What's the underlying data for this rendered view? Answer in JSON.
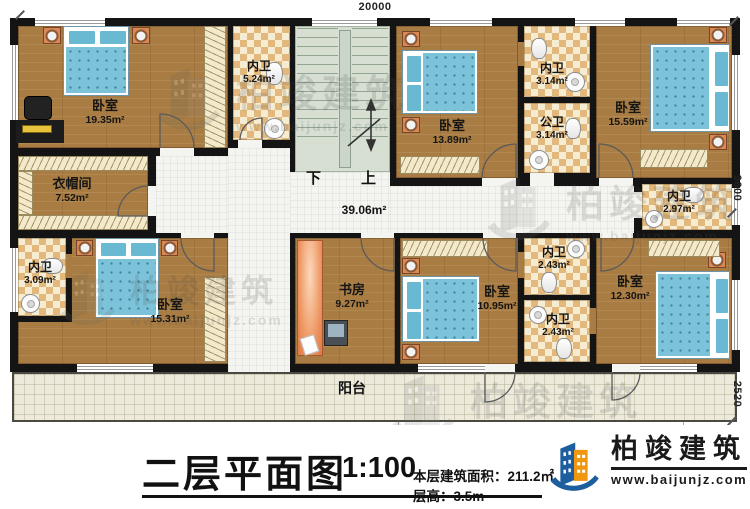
{
  "plan": {
    "dimensions": {
      "top": "20000",
      "right_upper": "9600",
      "right_lower": "2520"
    },
    "stairs": {
      "down": "下",
      "up": "上"
    },
    "corridor_area": "39.06m²",
    "balcony_label": "阳台",
    "rooms": {
      "bedroom_tl": {
        "name": "卧室",
        "area": "19.35m²"
      },
      "bath_tl": {
        "name": "内卫",
        "area": "5.24m²"
      },
      "bedroom_tm": {
        "name": "卧室",
        "area": "13.89m²"
      },
      "bath_tm": {
        "name": "内卫",
        "area": "3.14m²"
      },
      "bath_public": {
        "name": "公卫",
        "area": "3.14m²"
      },
      "bedroom_tr": {
        "name": "卧室",
        "area": "15.59m²"
      },
      "bath_tr": {
        "name": "内卫",
        "area": "2.97m²"
      },
      "cloakroom": {
        "name": "衣帽间",
        "area": "7.52m²"
      },
      "bath_bl": {
        "name": "内卫",
        "area": "3.09m²"
      },
      "bedroom_bl": {
        "name": "卧室",
        "area": "15.31m²"
      },
      "study": {
        "name": "书房",
        "area": "9.27m²"
      },
      "bedroom_bm": {
        "name": "卧室",
        "area": "10.95m²"
      },
      "bath_bm": {
        "name": "内卫",
        "area": "2.43m²"
      },
      "bath_bm2": {
        "name": "内卫",
        "area": "2.43m²"
      },
      "bedroom_br": {
        "name": "卧室",
        "area": "12.30m²"
      }
    }
  },
  "title_block": {
    "title": "二层平面图",
    "scale": "1:100",
    "floor_area": "本层建筑面积：211.2㎡",
    "floor_height": "层高：3.5m"
  },
  "brand": {
    "name": "柏竣建筑",
    "website": "www.baijunjz.com"
  }
}
